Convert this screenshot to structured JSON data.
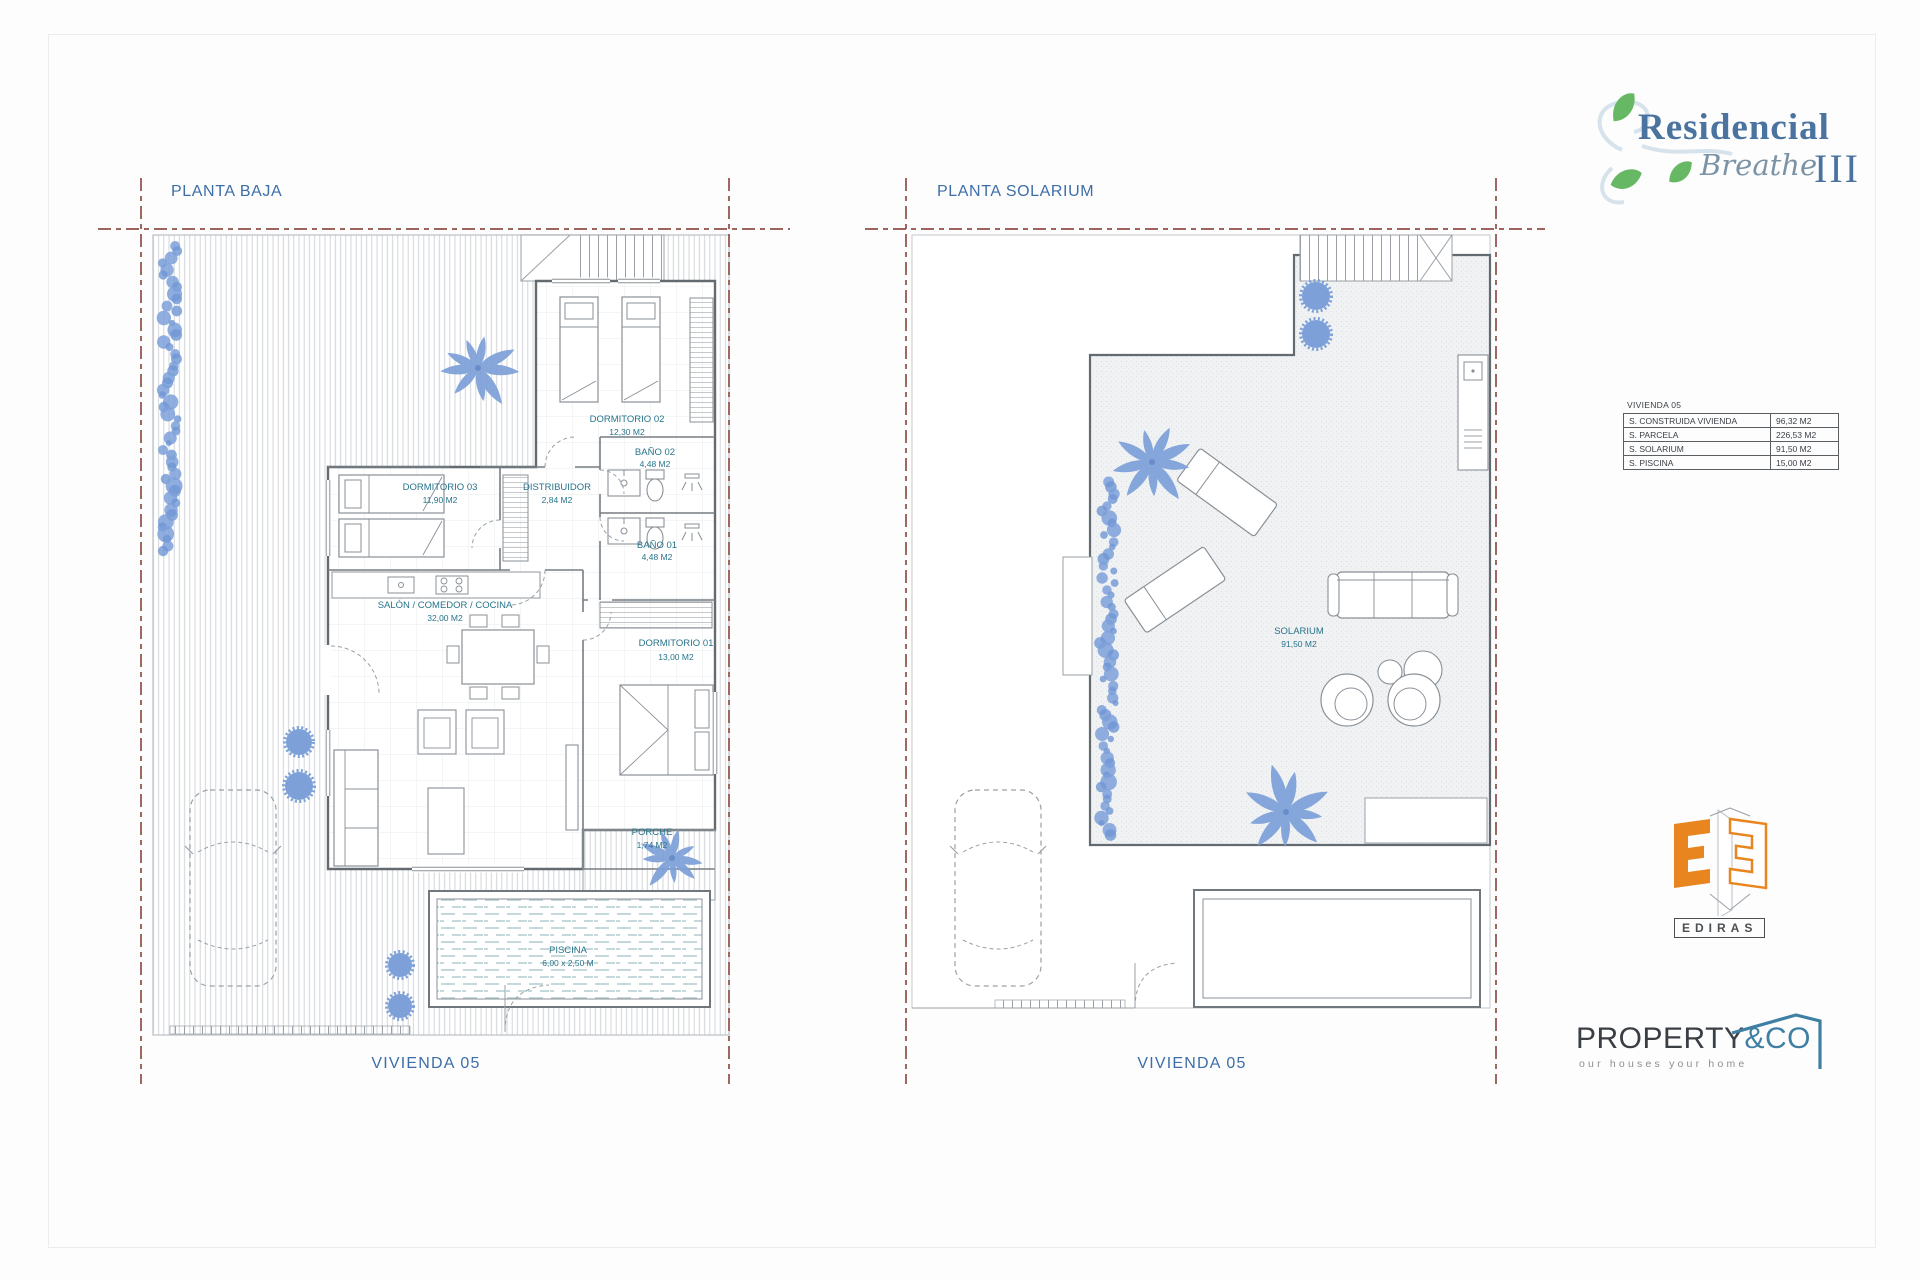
{
  "plans": [
    {
      "title": "PLANTA BAJA",
      "footer": "VIVIENDA 05",
      "rooms": [
        {
          "name": "DORMITORIO 02",
          "area": "12,30 M2"
        },
        {
          "name": "BAÑO 02",
          "area": "4,48 M2"
        },
        {
          "name": "DORMITORIO 03",
          "area": "11,90 M2"
        },
        {
          "name": "DISTRIBUIDOR",
          "area": "2,84 M2"
        },
        {
          "name": "BAÑO 01",
          "area": "4,48 M2"
        },
        {
          "name": "SALÓN / COMEDOR / COCINA",
          "area": "32,00 M2"
        },
        {
          "name": "DORMITORIO 01",
          "area": "13,00 M2"
        },
        {
          "name": "PORCHE",
          "area": "1,74 M2"
        },
        {
          "name": "PISCINA",
          "area": "6,00 x 2,50 M"
        }
      ]
    },
    {
      "title": "PLANTA SOLARIUM",
      "footer": "VIVIENDA 05",
      "rooms": [
        {
          "name": "SOLARIUM",
          "area": "91,50 M2"
        }
      ]
    }
  ],
  "summary_table": {
    "title": "VIVIENDA 05",
    "rows": [
      {
        "label": "S. CONSTRUIDA VIVIENDA",
        "value": "96,32 M2"
      },
      {
        "label": "S. PARCELA",
        "value": "226,53 M2"
      },
      {
        "label": "S. SOLARIUM",
        "value": "91,50 M2"
      },
      {
        "label": "S. PISCINA",
        "value": "15,00 M2"
      }
    ]
  },
  "logos": {
    "residencial": {
      "name": "Residencial",
      "script": "Breathe",
      "numeral": "III"
    },
    "ediras": {
      "label": "EDIRAS"
    },
    "property": {
      "brand": "PROPERTY",
      "suffix": "&CO",
      "tagline": "our houses your home"
    }
  },
  "colors": {
    "plan_text": "#27748a",
    "title_text": "#3d6ea8",
    "boundary_dash": "#8e4f46",
    "vegetation": "#7da0d9",
    "wall": "#636a70",
    "ediras_orange": "#e8851f",
    "property_blue": "#3e7fa3",
    "leaf_green": "#66b864"
  }
}
